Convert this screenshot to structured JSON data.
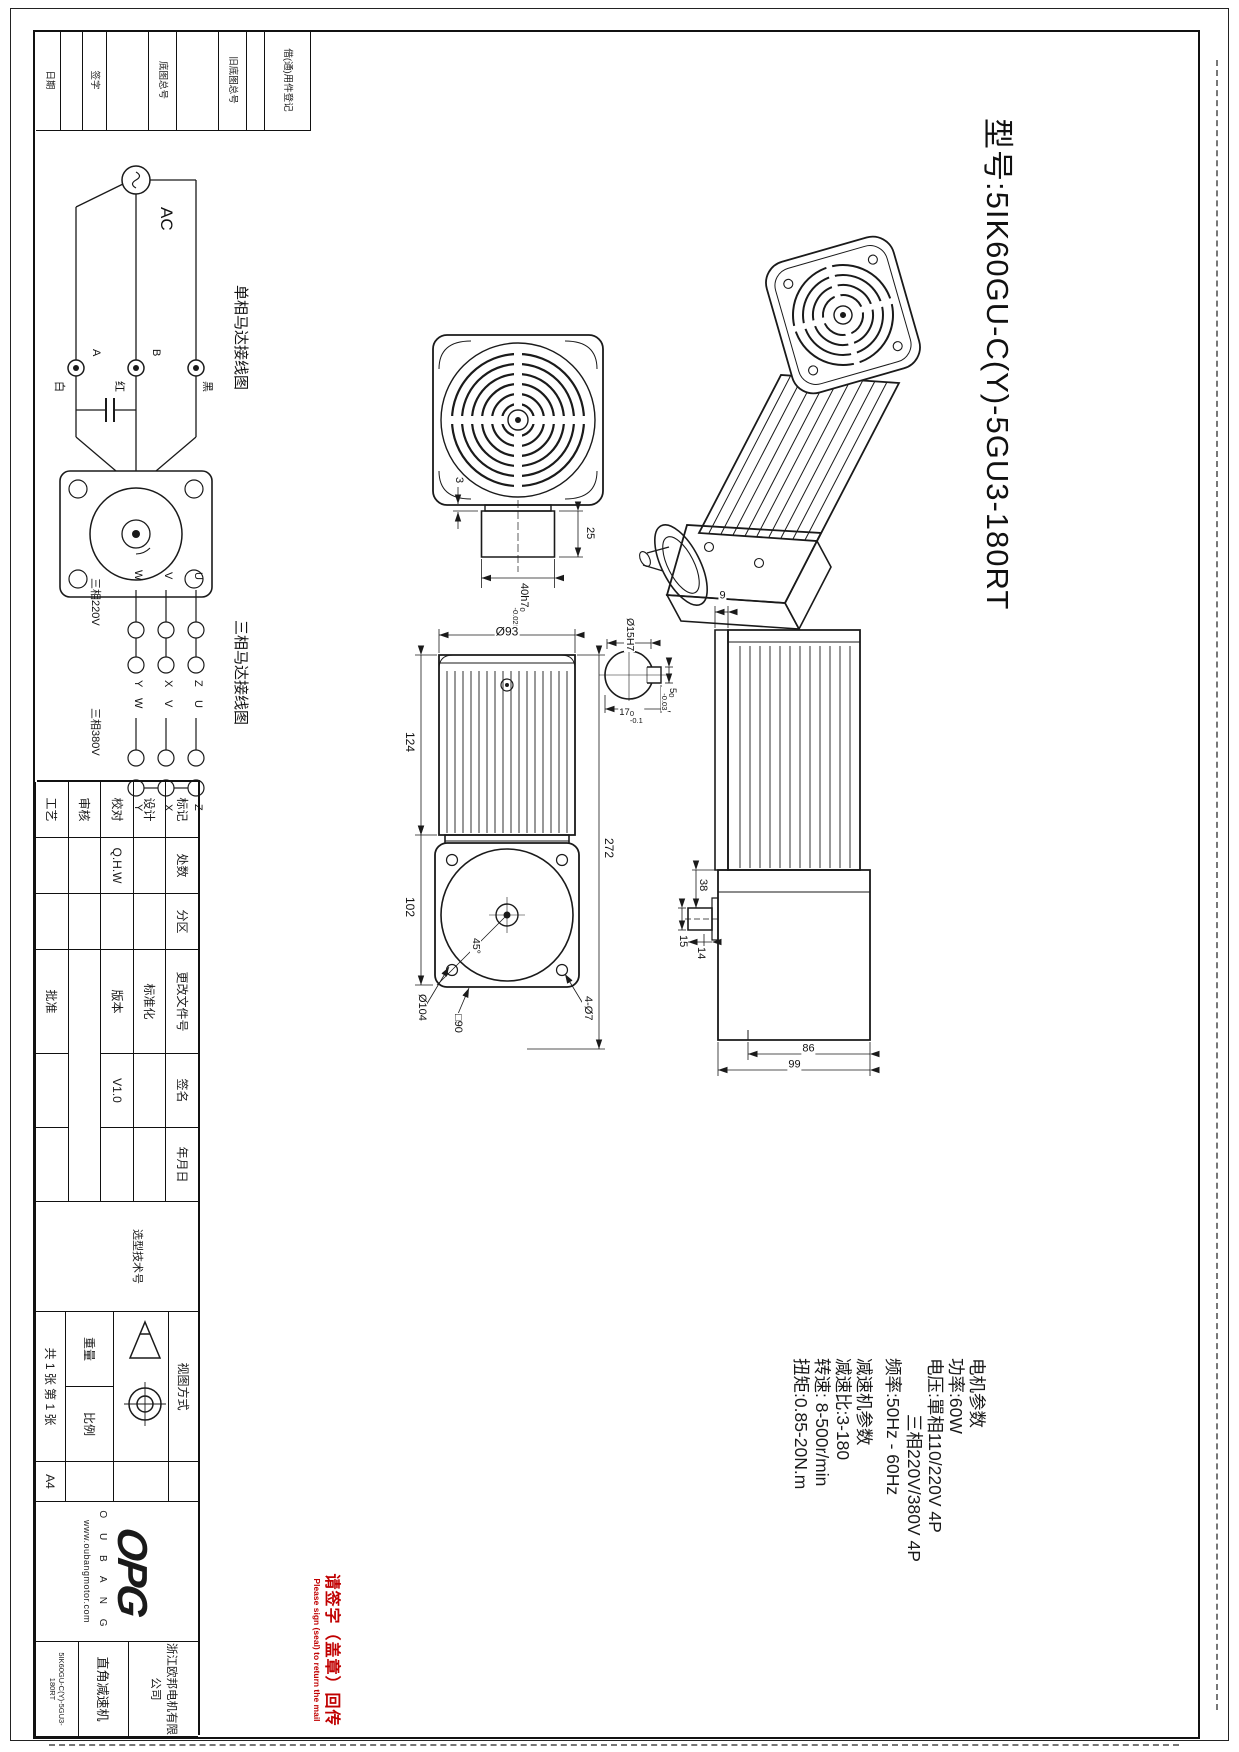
{
  "colors": {
    "ink": "#1a1a1a",
    "stamp_red": "#c00000"
  },
  "sheet_title": {
    "model": "型号:5IK60GU-C(Y)-5GU3-180RT"
  },
  "params": {
    "motor_header": "电机参数",
    "power": "功率:60W",
    "voltage1": "电压:單相110/220V 4P",
    "voltage2": "三相220V/380V 4P",
    "freq": "频率:50Hz - 60Hz",
    "reducer_header": "减速机参数",
    "ratio": "减速比:3-180",
    "speed": "转速: 8-500r/min",
    "torque": "扭矩:0.85-20N.m"
  },
  "wiring_single": {
    "caption": "单相马达接线图",
    "ac_label": "AC",
    "term_a": "A",
    "term_b": "B",
    "wire_white": "白",
    "wire_red": "红",
    "wire_black": "黑"
  },
  "wiring_three": {
    "caption": "三相马达接线图",
    "label_220": "三相220V",
    "label_380": "三相380V",
    "u": "U",
    "v": "V",
    "w": "W",
    "z": "Z",
    "x": "X",
    "y": "Y"
  },
  "rear_view": {
    "step": "3",
    "shaft_len": "25",
    "shaft_dia": "40h7",
    "tol_up": "0",
    "tol_dn": "-0.025"
  },
  "key_detail": {
    "bore": "Ø15H7",
    "key_w": "5",
    "key_w_up": "0",
    "key_w_dn": "-0.03",
    "key_h": "17",
    "key_h_up": "0",
    "key_h_dn": "-0.1"
  },
  "front_view": {
    "body_dia": "Ø93",
    "motor_len": "124",
    "gear_len": "102",
    "total_len": "272",
    "flange_dia": "Ø104",
    "flange_sq": "□90",
    "holes": "4-Ø7",
    "chamfer": "45°"
  },
  "side_view": {
    "plate": "9",
    "shaft_dia": "15",
    "offset": "38",
    "boss": "14",
    "h86": "86",
    "h99": "99"
  },
  "edge_strip": {
    "borrow": "借(通)用件登记",
    "old_base_no": "旧底图总号",
    "base_no": "底图总号",
    "sign": "签字",
    "date": "日期"
  },
  "titleblock": {
    "mark": "标记",
    "qty": "处数",
    "zone": "分区",
    "change_doc": "更改文件号",
    "sig": "签名",
    "date": "年月日",
    "design": "设计",
    "standardize": "标准化",
    "proof": "校对",
    "proof_val": "Q.H.W",
    "version_label": "版本",
    "version": "V1.0",
    "review": "审核",
    "process": "工艺",
    "approve": "批准",
    "selection": "选型技术号",
    "view_method": "视图方式",
    "weight": "重量",
    "scale": "比例",
    "sheet": "共 1 张 第 1 张",
    "paper": "A4",
    "logo": "OPG",
    "logo_letters": "O U B A N G",
    "url": "www.oubangmotor.com",
    "company_1": "浙江欧邦电机有限",
    "company_2": "公司",
    "product": "直角减速机",
    "part_no": "5IK60GU-C(Y)-5GU3-180RT"
  },
  "stamp": {
    "cn": "请签字（盖章）回传",
    "en": "Please sign (seal) to return the mail"
  }
}
